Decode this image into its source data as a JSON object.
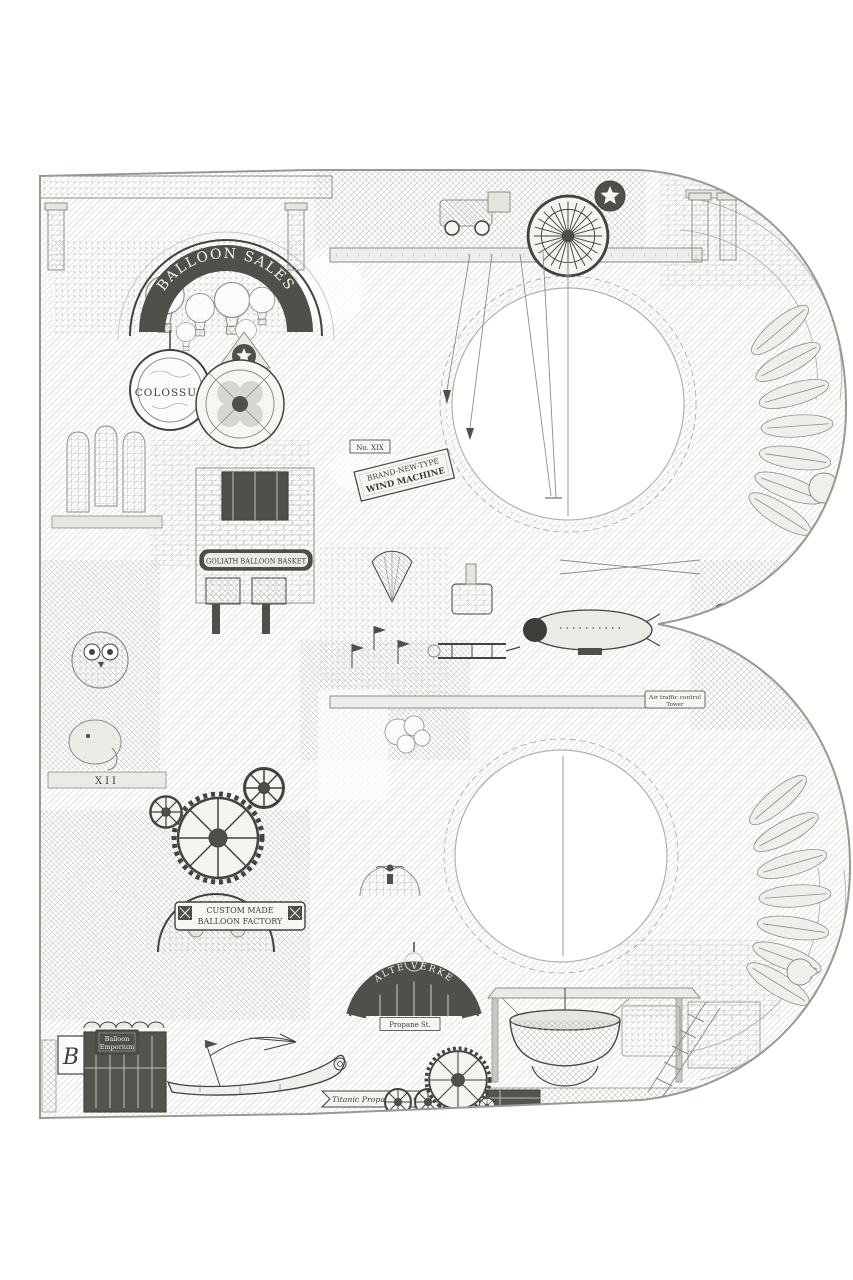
{
  "artwork": {
    "letter": "B",
    "palette": {
      "paper": "#ffffff",
      "ink": "#44423e",
      "dark_accent": "#514f4a",
      "mid_gray": "#8e8c86",
      "light_gray": "#c9c7c0",
      "panel_light": "#f3f2ef"
    },
    "signs": {
      "balloon_sales": "BALLOON SALES",
      "colossus": "COLOSSUS",
      "goliath": "GOLIATH BALLOON BASKET",
      "custom_line1": "CUSTOM MADE",
      "custom_line2": "BALLOON FACTORY",
      "machine_no": "No. XIX",
      "machine_line1": "BRAND-NEW-TYPE",
      "machine_line2": "WIND MACHINE",
      "tower_line1": "Air traffic control",
      "tower_line2": "Tower",
      "arch_lettering": "ALTE VERKE",
      "street_sign": "Propane St.",
      "ribbon": "Titanic Propane Inc.",
      "monogram": "B",
      "shop_line1": "Balloon",
      "shop_line2": "Emporium",
      "frieze_numeral": "XII"
    }
  }
}
